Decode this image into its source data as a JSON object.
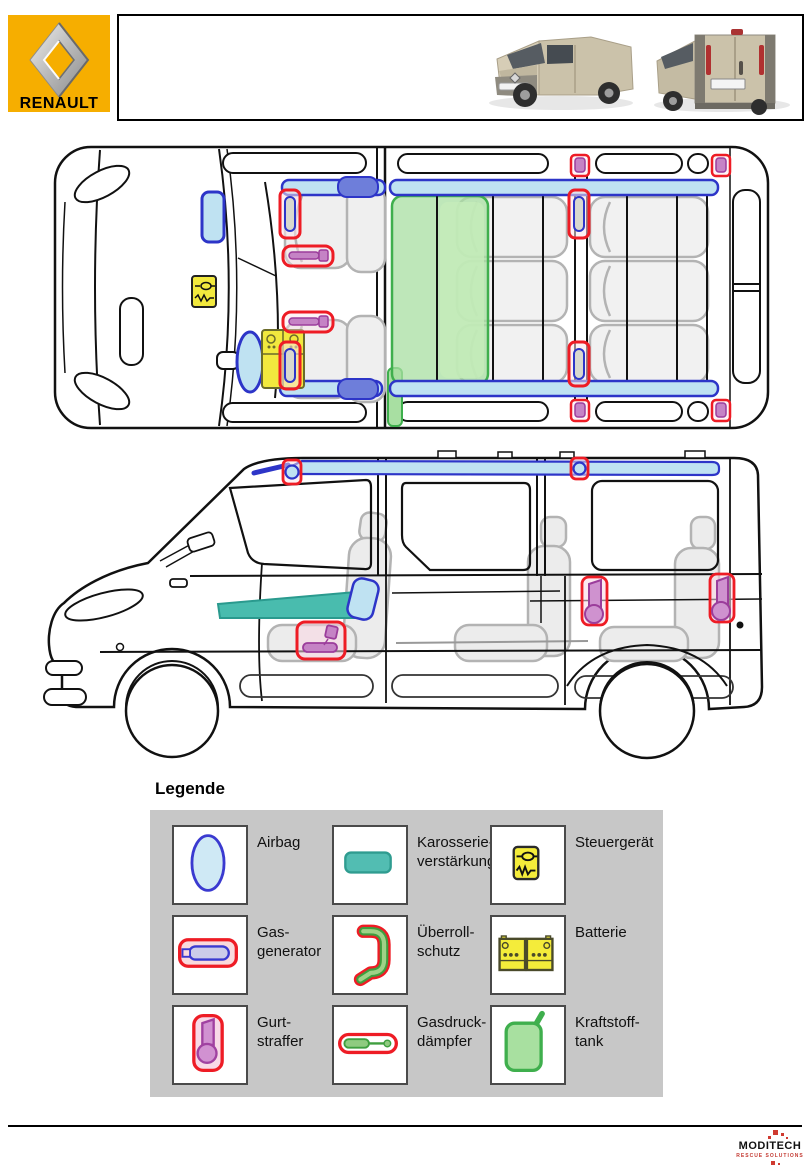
{
  "header": {
    "brand": "RENAULT"
  },
  "legend": {
    "title": "Legende",
    "items": [
      {
        "id": "airbag",
        "line1": "Airbag",
        "line2": ""
      },
      {
        "id": "karosserieverstaerkung",
        "line1": "Karosserie-",
        "line2": "verstärkung"
      },
      {
        "id": "steuergeraet",
        "line1": "Steuergerät",
        "line2": ""
      },
      {
        "id": "gasgenerator",
        "line1": "Gas-",
        "line2": "generator"
      },
      {
        "id": "ueberrollschutz",
        "line1": "Überroll-",
        "line2": "schutz"
      },
      {
        "id": "batterie",
        "line1": "Batterie",
        "line2": ""
      },
      {
        "id": "gurtstraffer",
        "line1": "Gurt-",
        "line2": "straffer"
      },
      {
        "id": "gasdruckdaempfer",
        "line1": "Gasdruck-",
        "line2": "dämpfer"
      },
      {
        "id": "kraftstofftank",
        "line1": "Kraftstoff-",
        "line2": "tank"
      }
    ]
  },
  "footer": {
    "logo_main": "MODITECH",
    "logo_sub": "RESCUE SOLUTIONS"
  },
  "colors": {
    "brand_yellow": "#f6ae00",
    "marker_red": "#ee1c25",
    "airbag_blue_stroke": "#2d35c8",
    "airbag_blue_fill": "#bfe2f2",
    "reinforcement_teal": "#49bcae",
    "pretensioner_purple": "#c583c5",
    "tank_green": "#a8dfa2",
    "device_yellow": "#f2e93e",
    "legend_panel_gray": "#c7c7c7"
  }
}
